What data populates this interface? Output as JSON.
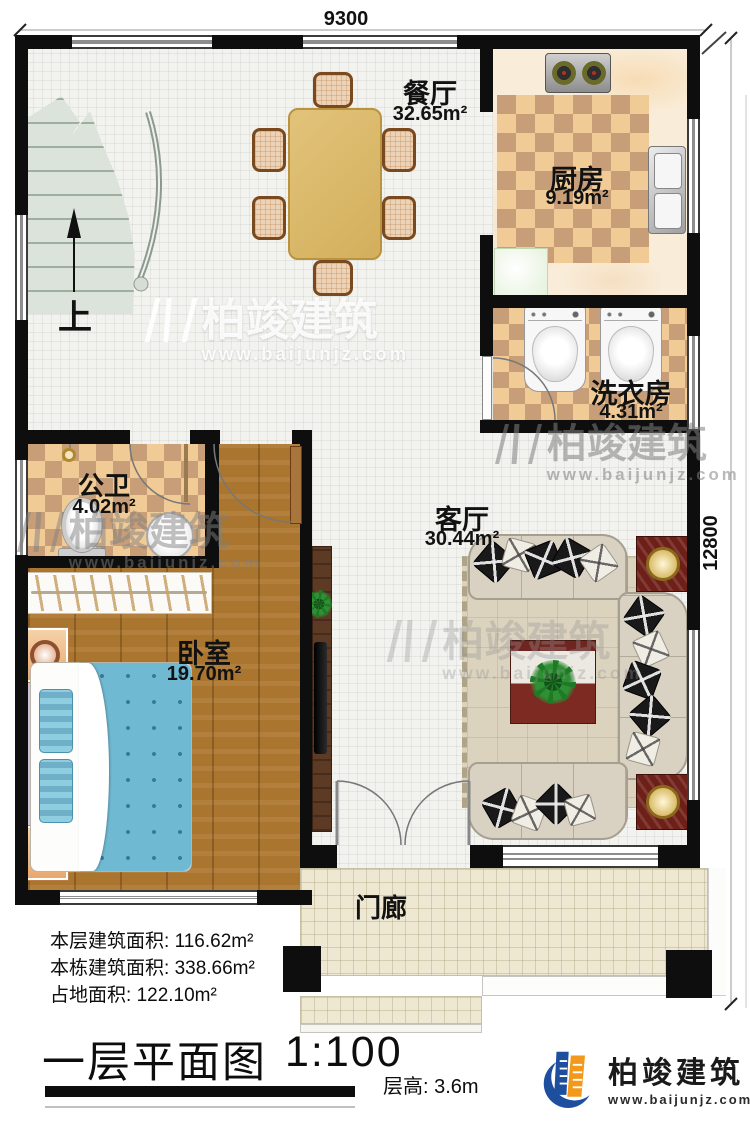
{
  "meta": {
    "title": "一层平面图",
    "scale": "1:100",
    "floor_height_label": "层高:",
    "floor_height_value": "3.6m"
  },
  "dims": {
    "top": "9300",
    "right": "12800"
  },
  "areas": [
    {
      "label": "本层建筑面积:",
      "value": "116.62m²"
    },
    {
      "label": "本栋建筑面积:",
      "value": "338.66m²"
    },
    {
      "label": "占地面积:",
      "value": "122.10m²"
    }
  ],
  "rooms": [
    {
      "id": "dining",
      "name": "餐厅",
      "area": "32.65m²"
    },
    {
      "id": "kitchen",
      "name": "厨房",
      "area": "9.19m²"
    },
    {
      "id": "laundry",
      "name": "洗衣房",
      "area": "4.31m²"
    },
    {
      "id": "bathroom",
      "name": "公卫",
      "area": "4.02m²"
    },
    {
      "id": "bedroom",
      "name": "卧室",
      "area": "19.70m²"
    },
    {
      "id": "living",
      "name": "客厅",
      "area": "30.44m²"
    },
    {
      "id": "porch",
      "name": "门廊",
      "area": ""
    }
  ],
  "stairs": {
    "up_label": "上"
  },
  "brand": {
    "name": "柏竣建筑",
    "url": "www.baijunjz.com"
  },
  "watermark": {
    "name": "柏竣建筑",
    "url": "www.baijunjz.com"
  },
  "colors": {
    "wall": "#0e0e0e",
    "wood_floor": "#a9752f",
    "tile_light": "#f0cb96",
    "tile_dark": "#c79e78",
    "bed_blue": "#6fb9d2",
    "sofa_beige": "#d9d2c3",
    "logo_blue": "#1d4f9e",
    "logo_orange": "#f2991c"
  }
}
